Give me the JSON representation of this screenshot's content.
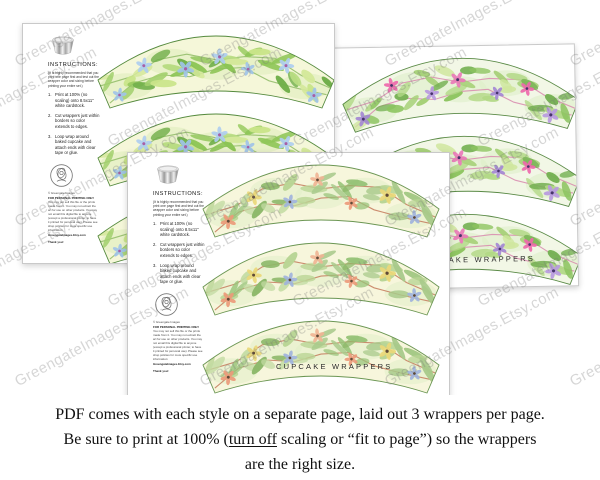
{
  "watermark": {
    "text": "GreengateImages.Etsy.com"
  },
  "caption": {
    "line1": "PDF comes with each style on a separate page, laid out 3 wrappers per page.",
    "line2_pre": "Be sure to print at 100% (",
    "line2_underline": "turn off",
    "line2_post": " scaling or “fit to page”) so the wrappers",
    "line3": "are the right size."
  },
  "page_template": {
    "instructions_title": "INSTRUCTIONS:",
    "instructions_note": "(It is highly recommended that you print one page first and test out the wrapper color and sizing before printing your entire set.)",
    "steps": [
      {
        "num": "1.",
        "text": "Print at 100% (no scaling) onto 8.5x11\" white cardstock."
      },
      {
        "num": "2.",
        "text": "Cut wrappers just within borders so color extends to edges."
      },
      {
        "num": "3.",
        "text": "Loop wrap around baked cupcake and attach ends with clear tape or glue."
      }
    ],
    "copyright": "© Greengate Images",
    "personal_use_title": "FOR PERSONAL PRINTING ONLY",
    "personal_use_body": "You may not sell this file or the prints made from it. You may not extract the art for use on other products. You may not email this digital file to anyone (except a professional printer, to have it printed for personal use). Please see shop policies for more specific use information:",
    "shop_url": "GreengateImages.Etsy.com",
    "thanks": "Thank you!",
    "footer_label": "CUPCAKE WRAPPERS",
    "logo_text": "GREENGATE IMAGES"
  },
  "pages": [
    {
      "name": "greenery-blue-floral",
      "palette": {
        "bg": "#f5f7d9",
        "wash": "#dcedba",
        "border": "#558a3e",
        "branch": "#8fbb66",
        "greens": [
          "#8cc455",
          "#b8dc82",
          "#d4e89a",
          "#6fae49",
          "#a3d06e",
          "#c9e489"
        ],
        "petals": [
          "#9fc3e8",
          "#aecdf0"
        ],
        "flower_center": "#a75fa5"
      }
    },
    {
      "name": "greenery-purple-pink-floral",
      "palette": {
        "bg": "#f2f7e6",
        "wash": "#ddeec6",
        "border": "#5a8a46",
        "branch": "#d88aae",
        "greens": [
          "#8cc45f",
          "#b2d886",
          "#cfe69d",
          "#74b052",
          "#a6d077"
        ],
        "petals": [
          "#a488d4",
          "#ee68ac",
          "#b89ae0",
          "#e97ab8"
        ],
        "flower_center": "#46346a"
      }
    },
    {
      "name": "greenery-peach-floral",
      "palette": {
        "bg": "#f7f6dc",
        "wash": "#e2efc8",
        "border": "#6b9653",
        "branch": "#c47a5c",
        "greens": [
          "#a8c98a",
          "#c2dba2",
          "#8db86a",
          "#b9d595",
          "#98c379"
        ],
        "petals": [
          "#eb9a79",
          "#ead878",
          "#9fb3dc",
          "#f0b494"
        ],
        "flower_center": "#5f4a38"
      }
    }
  ]
}
